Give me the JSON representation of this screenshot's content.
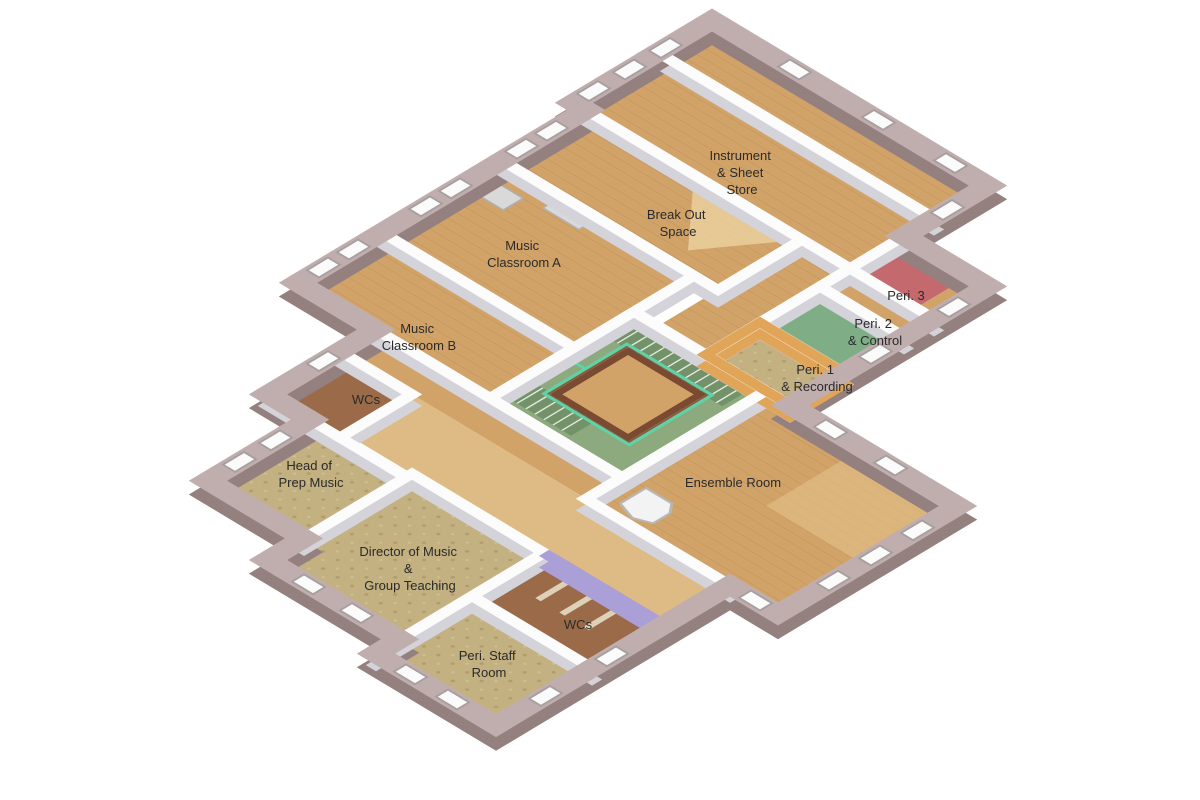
{
  "scene": {
    "type": "isometric-3d-floor-plan",
    "subject": "music-department-floor-plan",
    "background": "#ffffff"
  },
  "rooms": [
    {
      "id": "instrument-sheet-store",
      "lines": [
        "Instrument",
        "& Sheet",
        "Store"
      ],
      "floor": "wood"
    },
    {
      "id": "break-out-space",
      "lines": [
        "Break Out",
        "Space"
      ],
      "floor": "wood"
    },
    {
      "id": "music-classroom-a",
      "lines": [
        "Music",
        "Classroom A"
      ],
      "floor": "wood"
    },
    {
      "id": "music-classroom-b",
      "lines": [
        "Music",
        "Classroom B"
      ],
      "floor": "wood"
    },
    {
      "id": "peri-3",
      "lines": [
        "Peri. 3"
      ],
      "floor": "red-and-wood"
    },
    {
      "id": "peri-2-control",
      "lines": [
        "Peri. 2",
        "& Control"
      ],
      "floor": "green"
    },
    {
      "id": "peri-1-recording",
      "lines": [
        "Peri. 1",
        "& Recording"
      ],
      "floor": "carpet",
      "walls": "orange-timber"
    },
    {
      "id": "wcs-upper",
      "lines": [
        "WCs"
      ],
      "floor": "dark-wood"
    },
    {
      "id": "head-of-prep-music",
      "lines": [
        "Head of",
        "Prep Music"
      ],
      "floor": "carpet"
    },
    {
      "id": "ensemble-room",
      "lines": [
        "Ensemble Room"
      ],
      "floor": "wood",
      "furniture": "grand-piano"
    },
    {
      "id": "director-of-music-group-teaching",
      "lines": [
        "Director of Music",
        "&",
        "Group Teaching"
      ],
      "floor": "carpet"
    },
    {
      "id": "wcs-lower",
      "lines": [
        "WCs"
      ],
      "floor": "dark-wood",
      "walls": "lavender"
    },
    {
      "id": "peri-staff-room",
      "lines": [
        "Peri. Staff",
        "Room"
      ],
      "floor": "carpet"
    }
  ],
  "features": [
    "central-open-well-staircase",
    "mint-handrail",
    "stairwell-void-to-floor-below",
    "grand-piano",
    "exterior-windows"
  ],
  "palette": {
    "ext-top": "#c0aeae",
    "ext-side": "#94807f",
    "int-top": "#fcfcfd",
    "int-side": "#d4d3da",
    "wood": "#d2a368",
    "wood-light": "#debb84",
    "wood-dark": "#9a6a49",
    "carpet": "#c4b182",
    "carpet-dot": "#b09c6d",
    "sage": "#8caa7e",
    "steps": "#73926a",
    "green": "#7fae86",
    "red": "#c4696e",
    "purple": "#ab9fd8",
    "orange": "#e0a558",
    "trim": "#7a4a32",
    "rail": "#5fd2a7",
    "label": "#2a2a2a",
    "window": "#fbfbfc"
  }
}
